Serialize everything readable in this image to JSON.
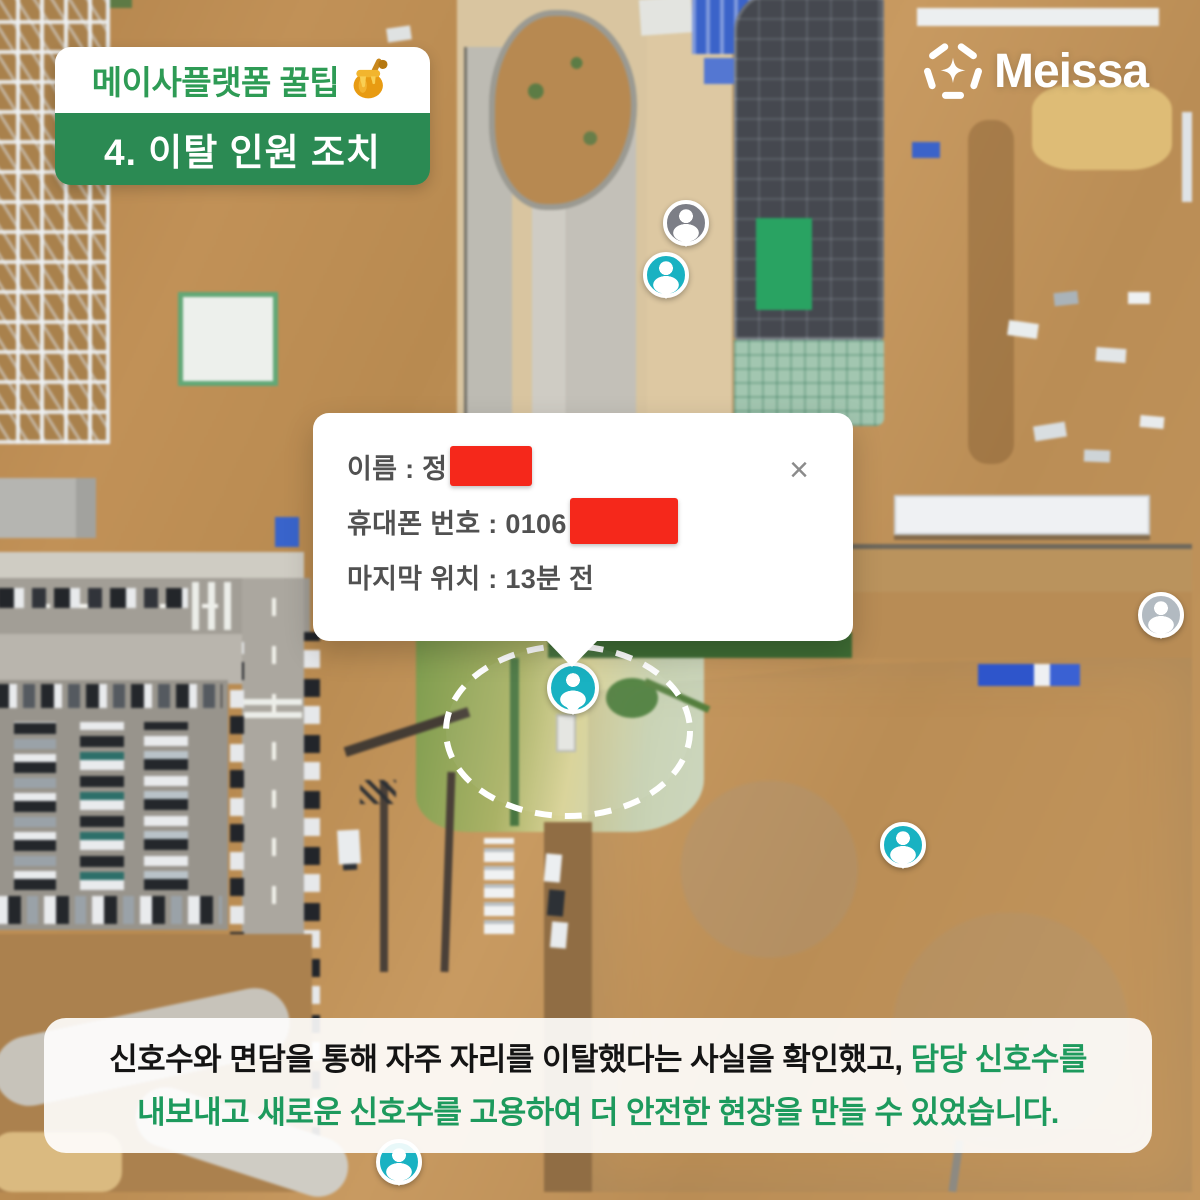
{
  "badge": {
    "title": "메이사플랫폼 꿀팁",
    "honey_icon": "honey-pot",
    "subtitle": "4. 이탈 인원 조치"
  },
  "logo": {
    "brand": "Meissa"
  },
  "popup": {
    "close_label": "×",
    "rows": [
      {
        "text": "이름 : 정",
        "redacted": true
      },
      {
        "text": "휴대폰 번호 : 0106",
        "redacted": true
      },
      {
        "text": "마지막 위치 : 13분 전",
        "redacted": false
      }
    ]
  },
  "banner": {
    "line1_black": "신호수와 면담을 통해 자주 자리를 이탈했다는 사실을 확인했고, ",
    "line1_green": "담당 신호수를",
    "line2_green": "내보내고 새로운 신호수를 고용하여 더 안전한 현장을 만들 수 있었습니다."
  },
  "map": {
    "description": "aerial drone view of construction site",
    "pins": [
      {
        "variant": "gray",
        "x": 686,
        "y": 225,
        "main": false
      },
      {
        "variant": "teal",
        "x": 666,
        "y": 277,
        "main": false
      },
      {
        "variant": "teal",
        "x": 573,
        "y": 690,
        "main": true
      },
      {
        "variant": "light",
        "x": 1161,
        "y": 617,
        "main": false
      },
      {
        "variant": "teal",
        "x": 903,
        "y": 847,
        "main": false
      },
      {
        "variant": "teal",
        "x": 399,
        "y": 1164,
        "main": false
      }
    ]
  },
  "colors": {
    "brand_green_band": "#2b8a53",
    "brand_green_text": "#2e9b55",
    "banner_green_text": "#1d9a5d",
    "pin_teal": "#19b2c2",
    "pin_gray": "#7c7e86",
    "redaction_red": "#f5281b",
    "logo_white": "#ffffff"
  }
}
